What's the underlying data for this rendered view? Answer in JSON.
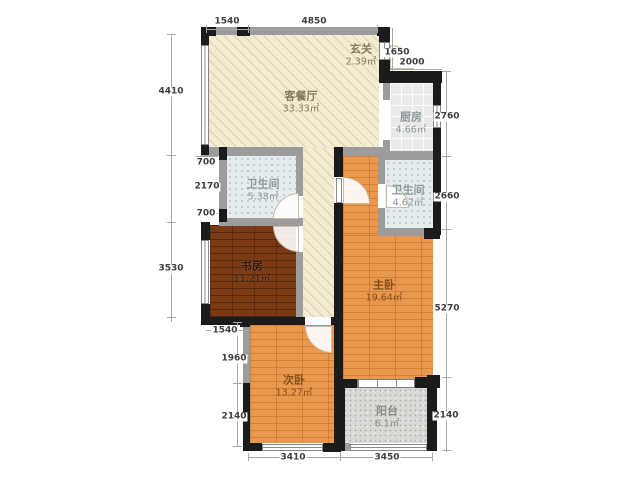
{
  "plan": {
    "title": "apartment-floor-plan",
    "rooms": {
      "entry": {
        "name": "玄关",
        "area": "2.39㎡"
      },
      "living": {
        "name": "客餐厅",
        "area": "33.33㎡"
      },
      "kitchen": {
        "name": "厨房",
        "area": "4.66㎡"
      },
      "bath1": {
        "name": "卫生间",
        "area": "5.38㎡"
      },
      "bath2": {
        "name": "卫生间",
        "area": "4.62㎡"
      },
      "study": {
        "name": "书房",
        "area": "11.21㎡"
      },
      "master": {
        "name": "主卧",
        "area": "19.64㎡"
      },
      "second": {
        "name": "次卧",
        "area": "13.27㎡"
      },
      "balcony": {
        "name": "阳台",
        "area": "6.1㎡"
      }
    },
    "dimensions": {
      "top_left": "1540",
      "top_main": "4850",
      "right_entry": "1650",
      "right_kitchen_width": "2000",
      "right_kitchen": "2760",
      "right_bath": "2660",
      "right_master": "5270",
      "right_balcony": "2140",
      "left_living": "4410",
      "left_offset_top": "700",
      "left_bath": "2170",
      "left_offset_bottom": "700",
      "left_study": "3530",
      "left_step": "1540",
      "left_second_upper": "1960",
      "left_second_lower": "2140",
      "bottom_second": "3410",
      "bottom_balcony": "3450"
    },
    "colors": {
      "wall_black": "#1b1b1b",
      "wall_grey": "#9c9c9c",
      "floor_beige": "#f4ebd3",
      "wood_orange": "#e9984f",
      "wood_dark": "#7b3a14",
      "bath_tile": "#e6eced",
      "kitchen_tile": "#e9e9e9",
      "balcony_tile": "#d8d8d6"
    }
  }
}
